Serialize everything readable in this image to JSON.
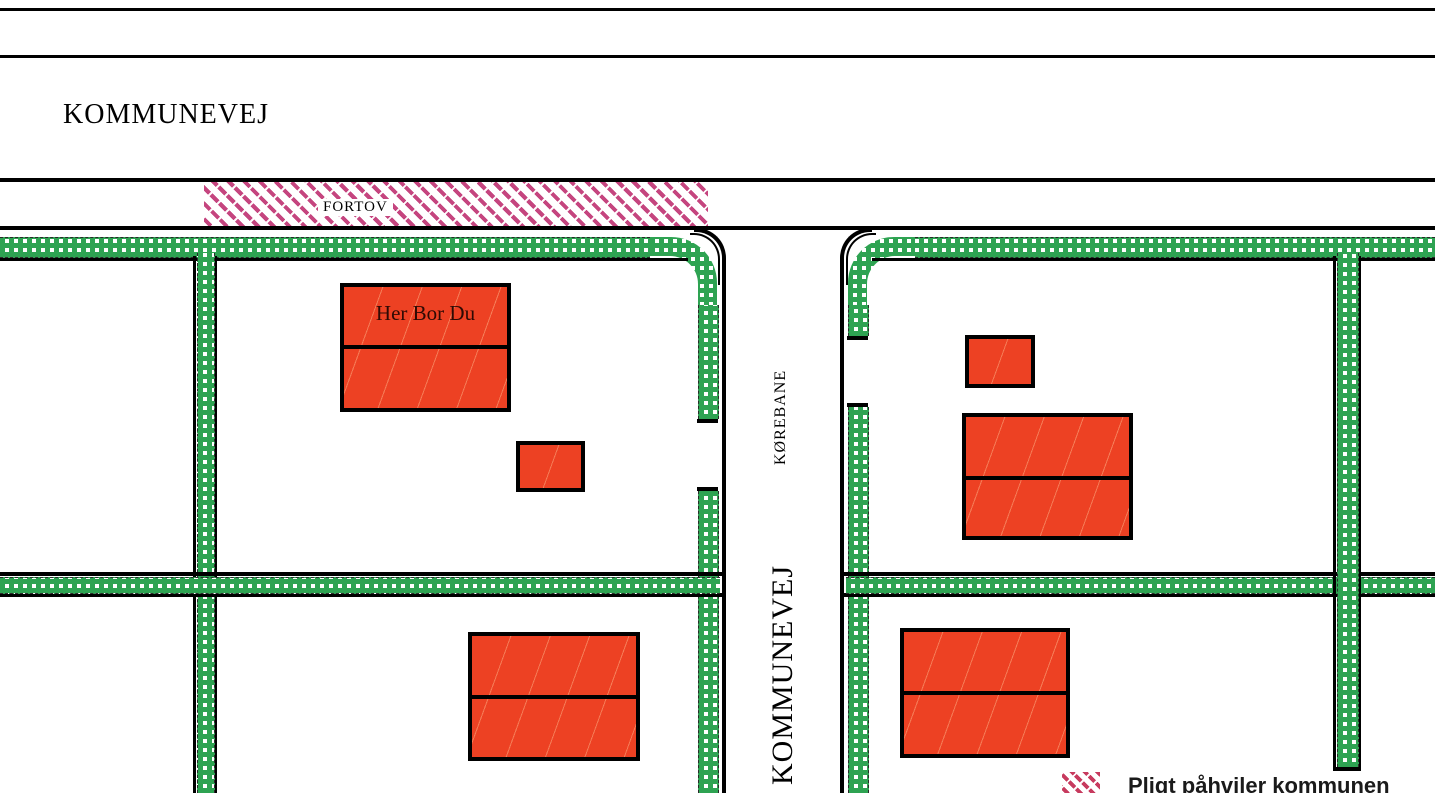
{
  "map": {
    "labels": {
      "road_top": "KOMMUNEVEJ",
      "sidewalk": "FORTOV",
      "roadway": "KØREBANE",
      "road_vertical": "KOMMUNEVEJ",
      "your_home": "Her Bor Du"
    },
    "legend": {
      "duty_text": "Pligt påhviler kommunen",
      "swatch_icon": "pink-diagonal-hatch"
    },
    "colors": {
      "hedge_green": "#2EA352",
      "sidewalk_hatch_pink": "#C5457F",
      "legend_hatch_crimson": "#C73A5E",
      "building_red": "#ED4123",
      "line_black": "#000000"
    }
  }
}
